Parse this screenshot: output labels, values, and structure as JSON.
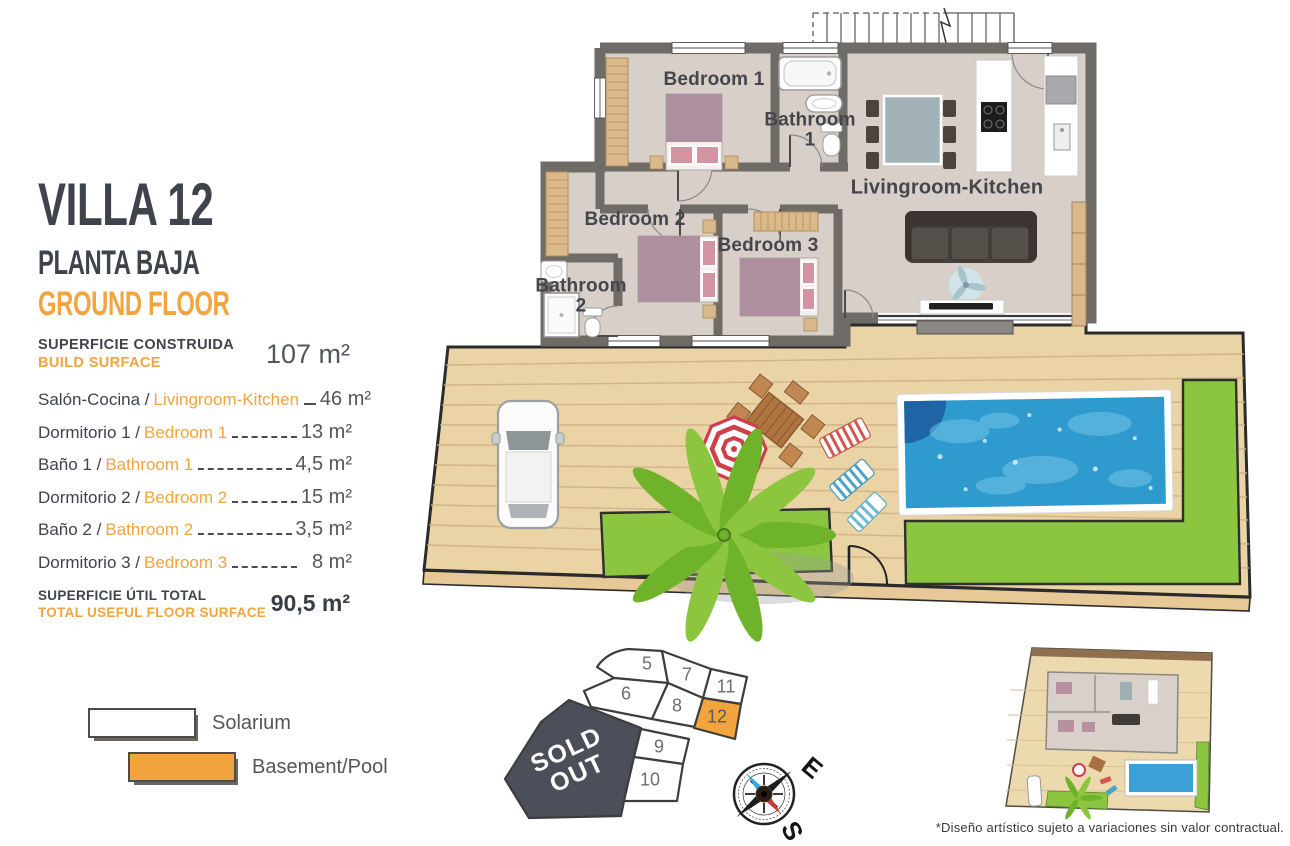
{
  "panel": {
    "title": "VILLA 12",
    "subtitle_es": "PLANTA BAJA",
    "subtitle_en": "GROUND FLOOR",
    "build_label_es": "SUPERFICIE CONSTRUIDA",
    "build_label_en": "BUILD SURFACE",
    "build_value": "107 m²",
    "rooms": [
      {
        "es": "Salón-Cocina /",
        "en": "Livingroom-Kitchen",
        "value": "46 m²"
      },
      {
        "es": "Dormitorio 1 /",
        "en": "Bedroom 1",
        "value": "13 m²"
      },
      {
        "es": "Baño 1 /",
        "en": "Bathroom 1",
        "value": "4,5 m²"
      },
      {
        "es": "Dormitorio 2 /",
        "en": "Bedroom 2",
        "value": "15 m²"
      },
      {
        "es": "Baño 2 /",
        "en": "Bathroom 2",
        "value": "3,5 m²"
      },
      {
        "es": "Dormitorio 3 /",
        "en": "Bedroom 3",
        "value": "8 m²"
      }
    ],
    "total_label_es": "SUPERFICIE ÚTIL TOTAL",
    "total_label_en": "TOTAL USEFUL FLOOR SURFACE",
    "total_value": "90,5 m²"
  },
  "legend": {
    "items": [
      {
        "label": "Solarium",
        "swatch": "#ffffff"
      },
      {
        "label": "Basement/Pool",
        "swatch": "#f2a43f"
      }
    ]
  },
  "floorplan": {
    "labels": {
      "bedroom1": "Bedroom 1",
      "bathroom1": "Bathroom\n1",
      "bedroom2": "Bedroom 2",
      "bedroom3": "Bedroom 3",
      "bathroom2": "Bathroom\n2",
      "living": "Livingroom-Kitchen"
    }
  },
  "siteplan": {
    "plots": [
      {
        "label": "5"
      },
      {
        "label": "7"
      },
      {
        "label": "11"
      },
      {
        "label": "6"
      },
      {
        "label": "8"
      },
      {
        "label": "12",
        "highlighted": true
      },
      {
        "label": "9"
      },
      {
        "label": "10"
      }
    ],
    "sold_out": "SOLD\nOUT"
  },
  "compass": {
    "east": "E",
    "south": "S"
  },
  "footnote": "*Diseño artístico sujeto a variaciones sin valor contractual.",
  "colors": {
    "accent_orange": "#f2a43f",
    "dark_text": "#3f434c",
    "wall_gray": "#6f6b67",
    "floor": "#d7cfc8",
    "deck": "#ead3a5",
    "grass": "#8cc640",
    "pool_water": "#2f9ace",
    "sold_out_bg": "#4a4f5a",
    "bed_mauve": "#ae8f9f",
    "wood": "#d9b88c"
  }
}
